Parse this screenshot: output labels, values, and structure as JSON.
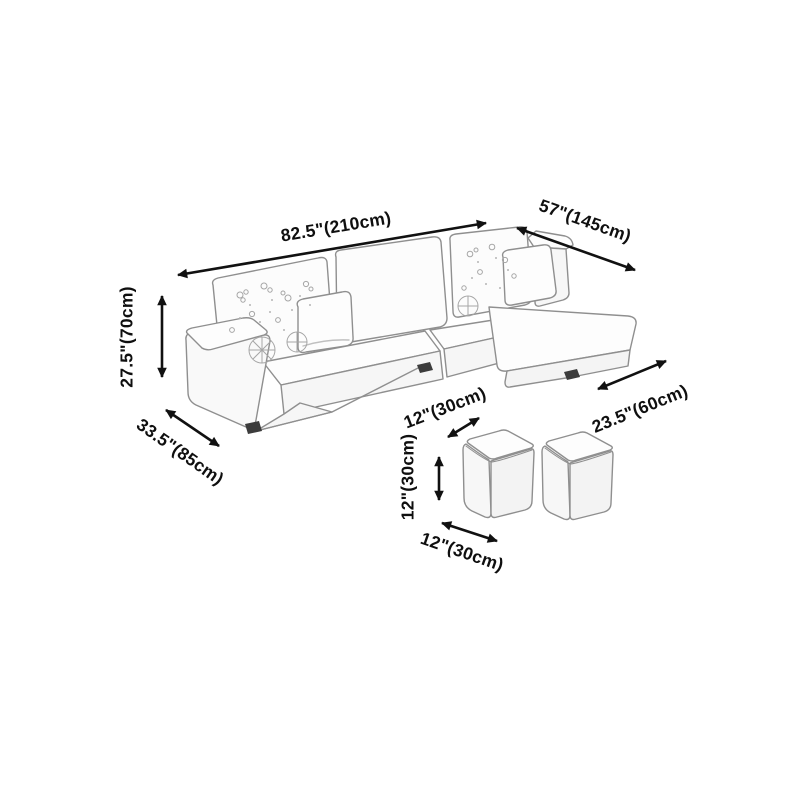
{
  "dimensions": {
    "sofa_overall_width": "82.5\"(210cm)",
    "sofa_chaise_side_length": "57\"(145cm)",
    "sofa_height": "27.5\"(70cm)",
    "sofa_depth": "33.5\"(85cm)",
    "chaise_width": "23.5\"(60cm)",
    "ottoman_top_width": "12\"(30cm)",
    "ottoman_height": "12\"(30cm)",
    "ottoman_bottom_width": "12\"(30cm)"
  },
  "colors": {
    "background": "#ffffff",
    "label_text": "#0f0f0f",
    "arrow": "#111111",
    "sketch_line": "#8f8f8f",
    "pattern_line": "#a6a6a6",
    "foot": "#3c3c3c"
  }
}
